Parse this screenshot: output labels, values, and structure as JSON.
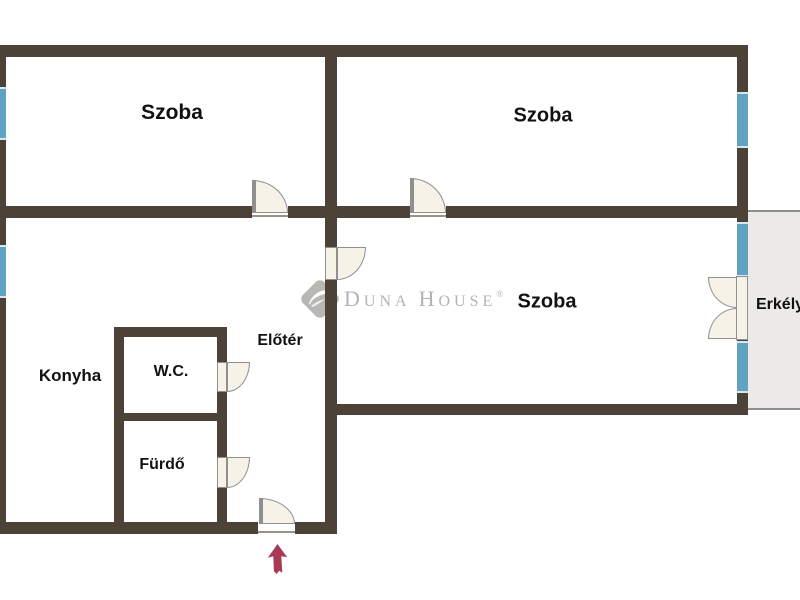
{
  "colors": {
    "bg": "#ffffff",
    "wall": "#4c4238",
    "window": "#61a2c3",
    "window_cap": "#d6e9f2",
    "door_fill": "#f7f2e7",
    "door_border": "#8f8f8f",
    "balcony_fill": "#eceae7",
    "balcony_border": "#8f8f8f",
    "threshold": "#9a938a",
    "label": "#111111",
    "logo_gray": "#b3b3b3",
    "arrow": "#a93a55"
  },
  "plan": {
    "rooms": [
      {
        "id": "szoba-top-left",
        "label": "Szoba"
      },
      {
        "id": "szoba-top-right",
        "label": "Szoba"
      },
      {
        "id": "szoba-middle",
        "label": "Szoba"
      },
      {
        "id": "konyha",
        "label": "Konyha"
      },
      {
        "id": "wc",
        "label": "W.C."
      },
      {
        "id": "furdo",
        "label": "Fürdő"
      },
      {
        "id": "eloter",
        "label": "Előtér"
      },
      {
        "id": "erkely",
        "label": "Erkély"
      }
    ]
  },
  "watermark": {
    "d": "D",
    "una": "UNA",
    "h": "H",
    "ouse": "OUSE",
    "registered": "®"
  }
}
